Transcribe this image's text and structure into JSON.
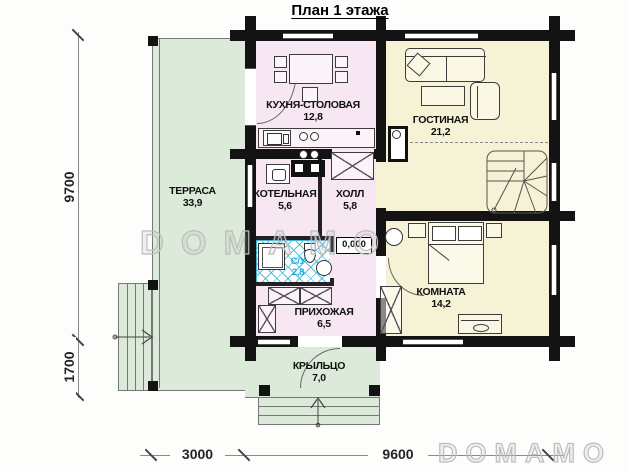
{
  "title": "План 1 этажа",
  "watermark": "DOMAMO",
  "rooms": {
    "terrace": {
      "name": "ТЕРРАСА",
      "area": "33,9"
    },
    "kitchen": {
      "name": "КУХНЯ-СТОЛОВАЯ",
      "area": "12,8"
    },
    "living": {
      "name": "ГОСТИНАЯ",
      "area": "21,2"
    },
    "boiler": {
      "name": "КОТЕЛЬНАЯ",
      "area": "5,6"
    },
    "hall": {
      "name": "ХОЛЛ",
      "area": "5,8"
    },
    "bathroom": {
      "name": "С/У",
      "area": "2,8"
    },
    "entry": {
      "name": "ПРИХОЖАЯ",
      "area": "6,5"
    },
    "bedroom": {
      "name": "КОМНАТА",
      "area": "14,2"
    },
    "porch": {
      "name": "КРЫЛЬЦО",
      "area": "7,0"
    }
  },
  "dimensions": {
    "left_total": "9700",
    "left_lower": "1700",
    "bottom_left": "3000",
    "bottom_right": "9600"
  },
  "level_mark": "0,000",
  "colors": {
    "terrace_green": "#dcead9",
    "room_pink": "#f6e7f3",
    "room_yellow": "#f5f2d6",
    "hatch_blue": "#3ebbe0",
    "wall": "#131313"
  }
}
